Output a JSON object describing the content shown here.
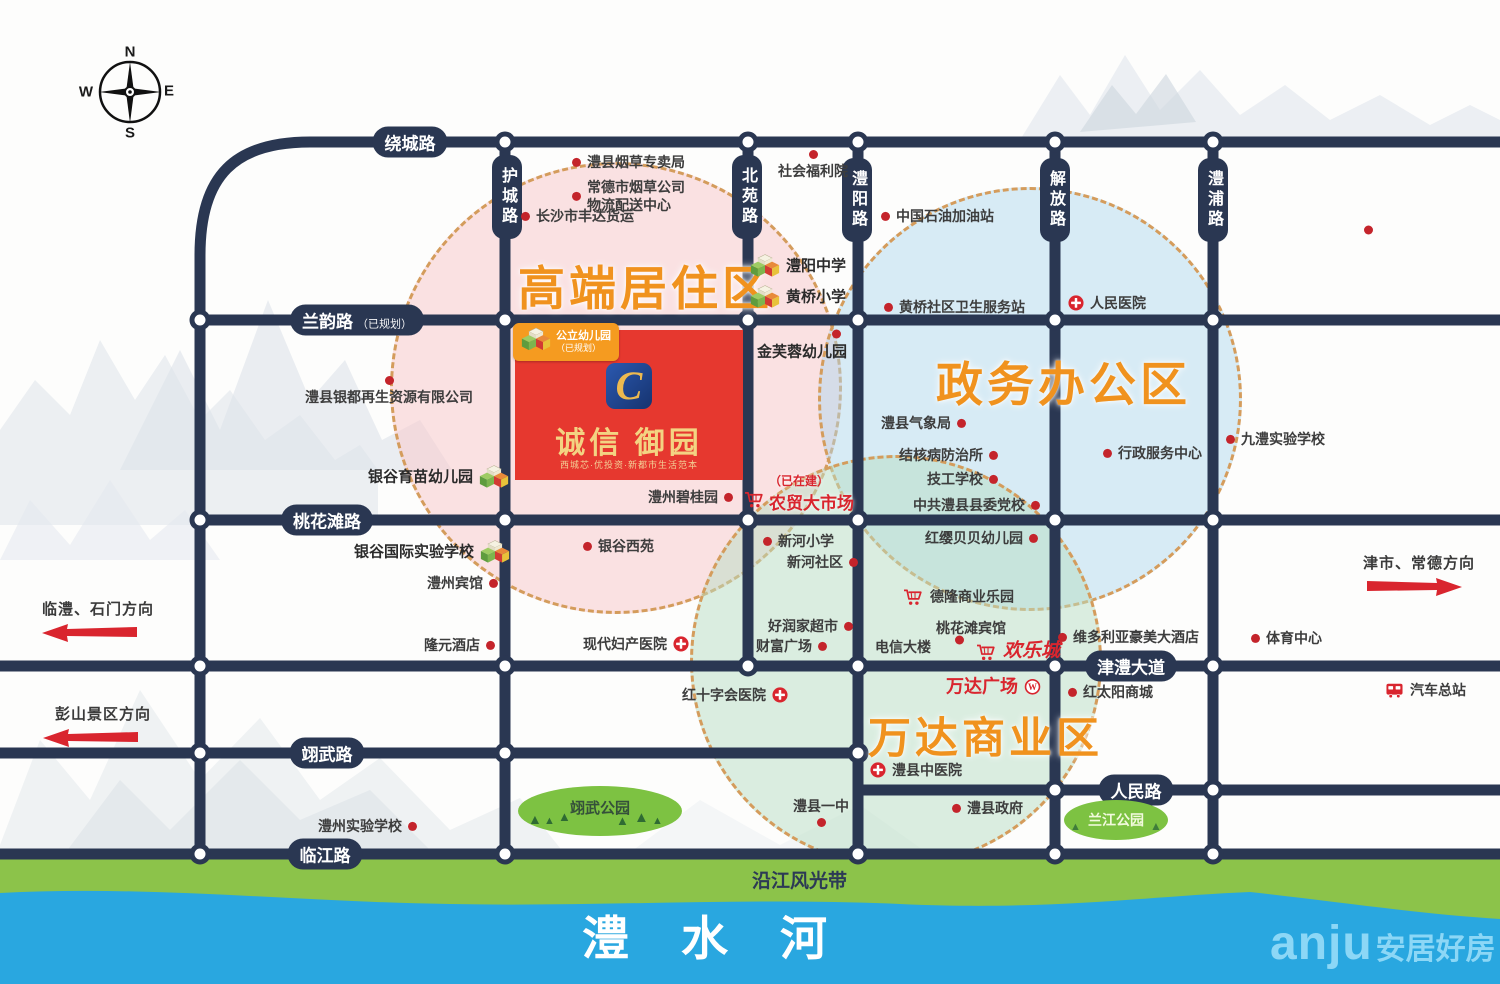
{
  "compass": {
    "n": "N",
    "s": "S",
    "e": "E",
    "w": "W"
  },
  "zones": [
    {
      "label": "高端居住区"
    },
    {
      "label": "政务办公区"
    },
    {
      "label": "万达商业区"
    }
  ],
  "project": {
    "badge": "公立幼儿园",
    "badge_sub": "（已规划）",
    "logo_letter": "C",
    "name": "诚信 御园",
    "tagline": "西城芯·优投资·新都市生活范本"
  },
  "market": {
    "status": "（已在建）",
    "name": "农贸大市场"
  },
  "roads": {
    "labels": [
      {
        "t": "绕城路",
        "x": 410,
        "y": 142,
        "o": "h"
      },
      {
        "t": "兰韵路",
        "suffix": "（已规划）",
        "x": 357,
        "y": 320,
        "o": "h"
      },
      {
        "t": "桃花滩路",
        "x": 327,
        "y": 520,
        "o": "h"
      },
      {
        "t": "津澧大道",
        "x": 1131,
        "y": 666,
        "o": "h"
      },
      {
        "t": "人民路",
        "x": 1136,
        "y": 790,
        "o": "h"
      },
      {
        "t": "翊武路",
        "x": 327,
        "y": 753,
        "o": "h"
      },
      {
        "t": "临江路",
        "x": 325,
        "y": 854,
        "o": "h"
      },
      {
        "t": "护城路",
        "x": 507,
        "y": 197,
        "o": "v"
      },
      {
        "t": "北苑路",
        "x": 747,
        "y": 197,
        "o": "v"
      },
      {
        "t": "澧阳路",
        "x": 857,
        "y": 200,
        "o": "v"
      },
      {
        "t": "解放路",
        "x": 1055,
        "y": 200,
        "o": "v"
      },
      {
        "t": "澧浦路",
        "x": 1213,
        "y": 200,
        "o": "v"
      }
    ],
    "dots": [
      [
        505,
        142
      ],
      [
        748,
        142
      ],
      [
        858,
        142
      ],
      [
        1055,
        142
      ],
      [
        1213,
        142
      ],
      [
        200,
        320
      ],
      [
        505,
        320
      ],
      [
        748,
        320
      ],
      [
        858,
        320
      ],
      [
        1055,
        320
      ],
      [
        1213,
        320
      ],
      [
        200,
        520
      ],
      [
        505,
        520
      ],
      [
        748,
        520
      ],
      [
        858,
        520
      ],
      [
        1055,
        520
      ],
      [
        1213,
        520
      ],
      [
        200,
        666
      ],
      [
        505,
        666
      ],
      [
        748,
        666
      ],
      [
        858,
        666
      ],
      [
        1055,
        666
      ],
      [
        1213,
        666
      ],
      [
        200,
        753
      ],
      [
        505,
        753
      ],
      [
        858,
        753
      ],
      [
        1055,
        790
      ],
      [
        1213,
        790
      ],
      [
        200,
        854
      ],
      [
        505,
        854
      ],
      [
        858,
        854
      ],
      [
        1055,
        854
      ],
      [
        1213,
        854
      ]
    ]
  },
  "pois": [
    {
      "t": "澧县烟草专卖局",
      "x": 572,
      "y": 162,
      "m": "dot",
      "s": "l"
    },
    {
      "t": "常德市烟草公司\n物流配送中心",
      "x": 572,
      "y": 196,
      "m": "dot",
      "s": "l"
    },
    {
      "t": "长沙市丰达货运",
      "x": 521,
      "y": 216,
      "m": "dot",
      "s": "l"
    },
    {
      "t": "社会福利院",
      "x": 778,
      "y": 150,
      "m": "dot",
      "s": "t"
    },
    {
      "t": "中国石油加油站",
      "x": 881,
      "y": 216,
      "m": "dot",
      "s": "l"
    },
    {
      "t": "澧阳中学",
      "x": 750,
      "y": 266,
      "m": "school",
      "s": "l",
      "b": 1
    },
    {
      "t": "黄桥小学",
      "x": 750,
      "y": 297,
      "m": "school",
      "s": "l",
      "b": 1
    },
    {
      "t": "金芙蓉幼儿园",
      "x": 757,
      "y": 352,
      "b": 1
    },
    {
      "t": "",
      "x": 832,
      "y": 334,
      "m": "dot"
    },
    {
      "t": "黄桥社区卫生服务站",
      "x": 884,
      "y": 307,
      "m": "dot",
      "s": "l"
    },
    {
      "t": "人民医院",
      "x": 1068,
      "y": 303,
      "m": "cross",
      "s": "l"
    },
    {
      "t": "澧县银都再生资源有限公司",
      "x": 305,
      "y": 376,
      "m": "dot",
      "s": "t"
    },
    {
      "t": "银谷育苗幼儿园",
      "x": 368,
      "y": 477,
      "m": "school",
      "s": "r",
      "b": 1
    },
    {
      "t": "银谷国际实验学校",
      "x": 354,
      "y": 552,
      "m": "school",
      "s": "r",
      "b": 1
    },
    {
      "t": "澧州宾馆",
      "x": 427,
      "y": 583,
      "m": "dot",
      "s": "r"
    },
    {
      "t": "隆元酒店",
      "x": 424,
      "y": 645,
      "m": "dot",
      "s": "r"
    },
    {
      "t": "银谷西苑",
      "x": 583,
      "y": 546,
      "m": "dot",
      "s": "l"
    },
    {
      "t": "澧州碧桂园",
      "x": 648,
      "y": 497,
      "m": "dot",
      "s": "r"
    },
    {
      "t": "现代妇产医院",
      "x": 583,
      "y": 644,
      "m": "cross",
      "s": "r"
    },
    {
      "t": "新河小学",
      "x": 763,
      "y": 541,
      "m": "dot",
      "s": "l"
    },
    {
      "t": "新河社区",
      "x": 787,
      "y": 562,
      "m": "dot",
      "s": "r"
    },
    {
      "t": "好润家超市",
      "x": 768,
      "y": 626,
      "m": "dot",
      "s": "r"
    },
    {
      "t": "财富广场",
      "x": 756,
      "y": 646,
      "m": "dot",
      "s": "r"
    },
    {
      "t": "红十字会医院",
      "x": 682,
      "y": 695,
      "m": "cross",
      "s": "r"
    },
    {
      "t": "澧县气象局",
      "x": 881,
      "y": 423,
      "m": "dot",
      "s": "r"
    },
    {
      "t": "结核病防治所",
      "x": 899,
      "y": 455,
      "m": "dot",
      "s": "r"
    },
    {
      "t": "技工学校",
      "x": 927,
      "y": 479,
      "m": "dot",
      "s": "r"
    },
    {
      "t": "中共澧县县委党校",
      "x": 913,
      "y": 505,
      "m": "dot",
      "s": "r"
    },
    {
      "t": "红缨贝贝幼儿园",
      "x": 925,
      "y": 538,
      "m": "dot",
      "s": "r"
    },
    {
      "t": "行政服务中心",
      "x": 1103,
      "y": 453,
      "m": "dot",
      "s": "l"
    },
    {
      "t": "九澧实验学校",
      "x": 1226,
      "y": 439,
      "m": "dot",
      "s": "l"
    },
    {
      "t": "德隆商业乐园",
      "x": 903,
      "y": 597,
      "m": "cart",
      "s": "l"
    },
    {
      "t": "桃花滩宾馆",
      "x": 936,
      "y": 628
    },
    {
      "t": "",
      "x": 955,
      "y": 640,
      "m": "dot"
    },
    {
      "t": "电信大楼",
      "x": 875,
      "y": 647
    },
    {
      "t": "欢乐城",
      "x": 976,
      "y": 652,
      "m": "cart",
      "s": "l",
      "cls": "red-big"
    },
    {
      "t": "维多利亚豪美大酒店",
      "x": 1058,
      "y": 637,
      "m": "dot",
      "s": "l"
    },
    {
      "t": "体育中心",
      "x": 1251,
      "y": 638,
      "m": "dot",
      "s": "l"
    },
    {
      "t": "万达广场",
      "x": 946,
      "y": 687,
      "m": "wanda",
      "s": "r",
      "cls": "red-mid"
    },
    {
      "t": "红太阳商城",
      "x": 1068,
      "y": 692,
      "m": "dot",
      "s": "l"
    },
    {
      "t": "汽车总站",
      "x": 1385,
      "y": 690,
      "m": "bus",
      "s": "l"
    },
    {
      "t": "澧县中医院",
      "x": 870,
      "y": 770,
      "m": "cross",
      "s": "l"
    },
    {
      "t": "澧县一中",
      "x": 793,
      "y": 797,
      "m": "dot",
      "s": "b"
    },
    {
      "t": "澧县政府",
      "x": 952,
      "y": 808,
      "m": "dot",
      "s": "l"
    },
    {
      "t": "澧州实验学校",
      "x": 318,
      "y": 826,
      "m": "dot",
      "s": "r"
    },
    {
      "t": "",
      "x": 1364,
      "y": 230,
      "m": "dot"
    }
  ],
  "directions": [
    {
      "label": "临澧、石门方向",
      "dir": "left"
    },
    {
      "label": "彭山景区方向",
      "dir": "left"
    },
    {
      "label": "津市、常德方向",
      "dir": "right"
    }
  ],
  "parks": [
    {
      "label": "翊武公园"
    },
    {
      "label": "兰江公园"
    }
  ],
  "river": {
    "bank": "沿江风光带",
    "name": "澧水河"
  },
  "watermark": {
    "latin": "anju",
    "cn": "安居好房"
  }
}
